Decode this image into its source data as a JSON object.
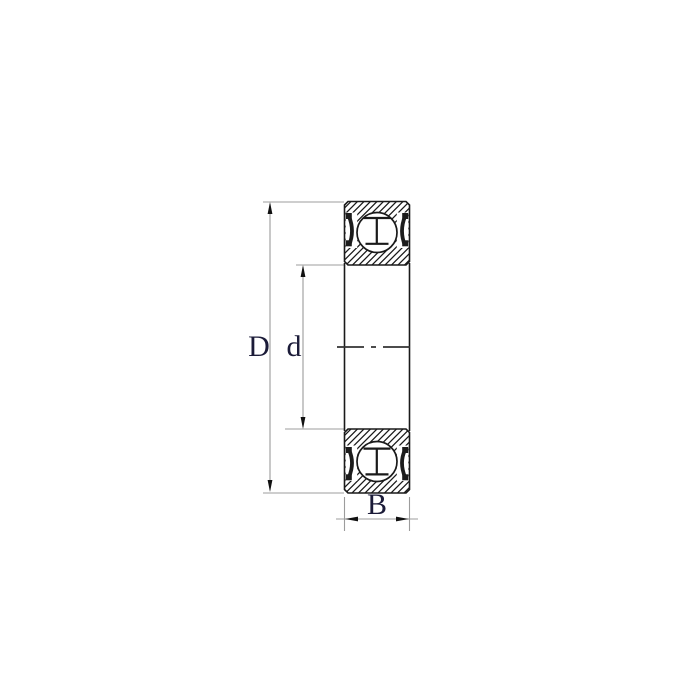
{
  "diagram": {
    "kind": "ball-bearing-cross-section",
    "labels": {
      "outer_diameter": "D",
      "bore_diameter": "d",
      "width": "B"
    },
    "colors": {
      "background": "#ffffff",
      "outline": "#1a1a1a",
      "hatch": "#1a1a1a",
      "dimension_line": "#9c9c9c",
      "arrow": "#111111",
      "label_text": "#1b1b38",
      "seal": "#1c1c1c",
      "centerline": "#333333"
    }
  }
}
